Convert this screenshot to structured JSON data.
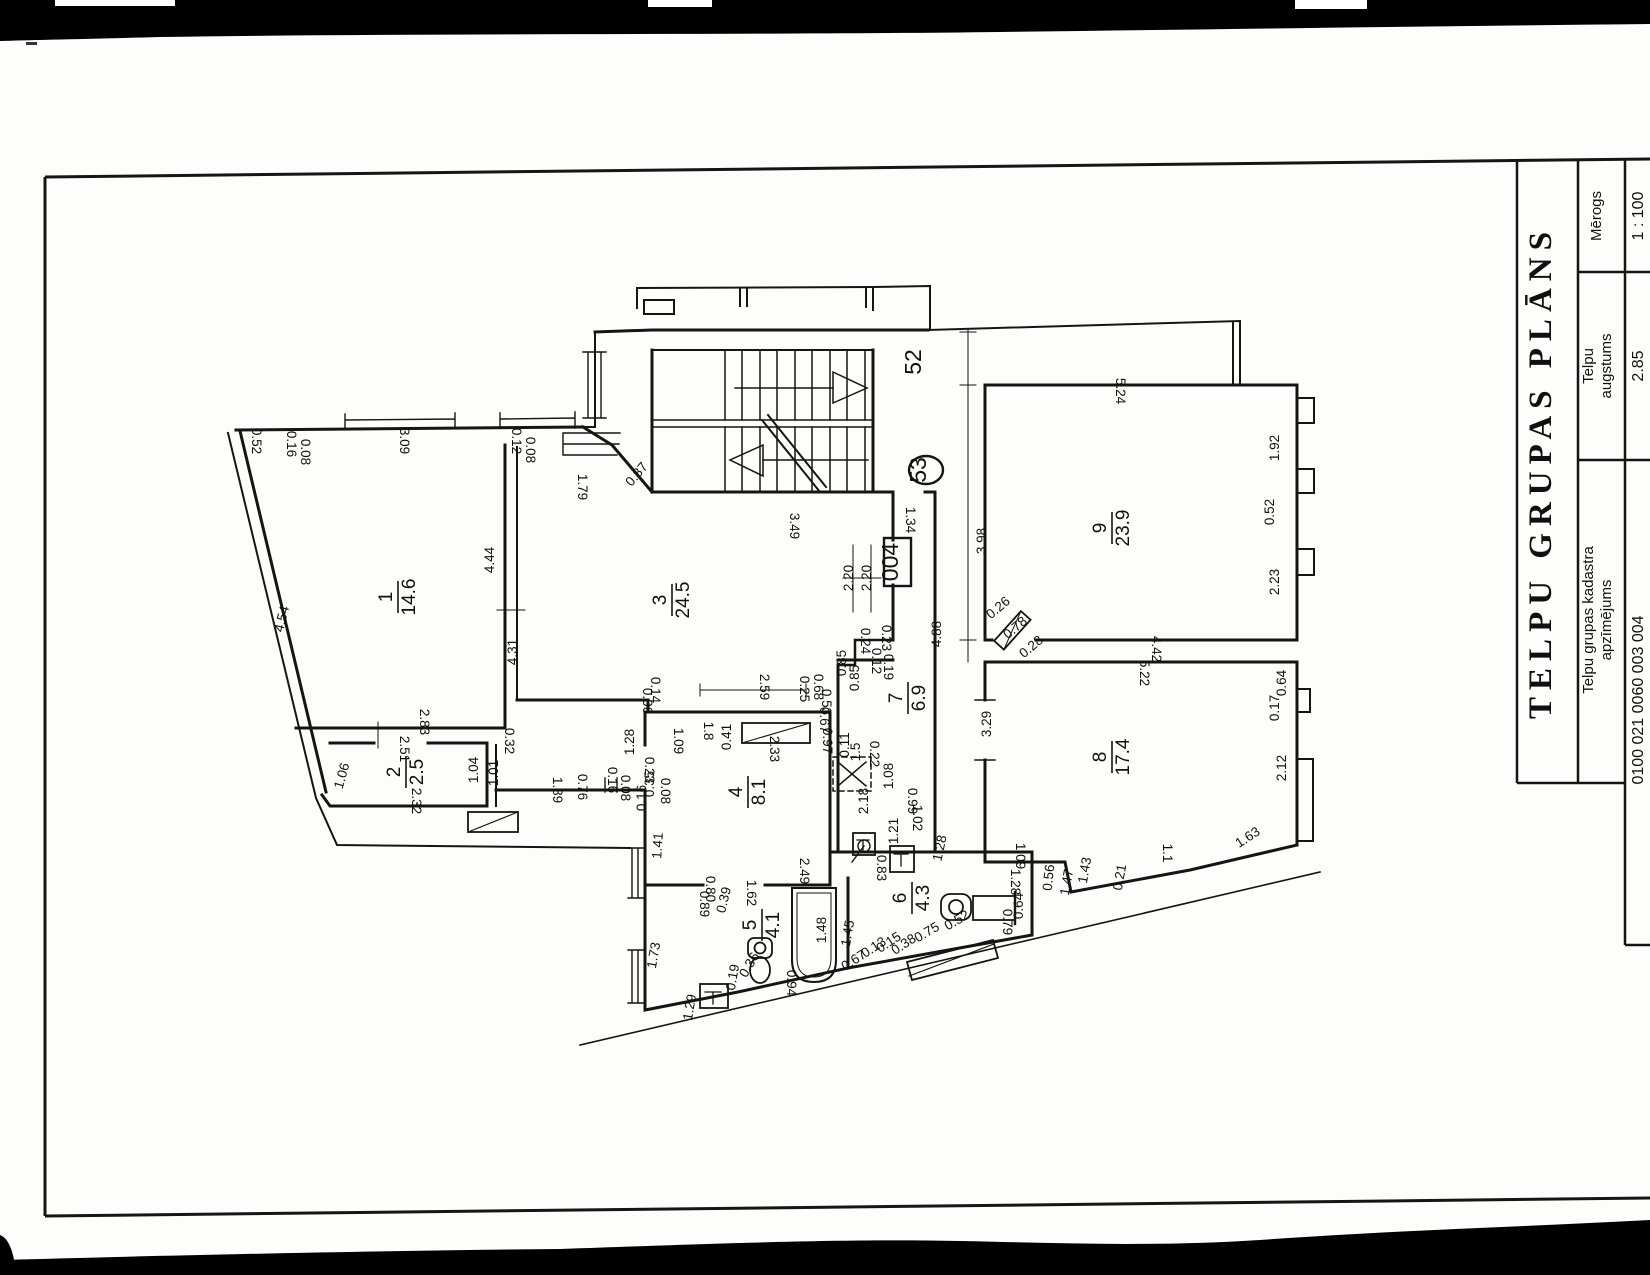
{
  "title_block": {
    "title": "TELPU GRUPAS PLĀNS",
    "fields": [
      {
        "label_lines": [
          "Mērogs"
        ],
        "value": "1 : 100"
      },
      {
        "label_lines": [
          "Telpu",
          "augstums"
        ],
        "value": "2.85"
      },
      {
        "label_lines": [
          "Telpu grupas kadastra",
          "apzīmējums"
        ],
        "value": "0100 021 0060 003 004"
      }
    ]
  },
  "plan": {
    "units": [
      {
        "label": "52",
        "x": 921,
        "y": 362
      },
      {
        "label": "53",
        "x": 926,
        "y": 470
      },
      {
        "label": "004",
        "x": 898,
        "y": 562
      }
    ],
    "rooms": [
      {
        "number": "1",
        "area": "14.6",
        "x": 398,
        "y": 597
      },
      {
        "number": "2",
        "area": "2.5",
        "x": 406,
        "y": 772
      },
      {
        "number": "3",
        "area": "24.5",
        "x": 672,
        "y": 600
      },
      {
        "number": "4",
        "area": "8.1",
        "x": 748,
        "y": 792
      },
      {
        "number": "5",
        "area": "4.1",
        "x": 762,
        "y": 925
      },
      {
        "number": "6",
        "area": "4.3",
        "x": 912,
        "y": 898
      },
      {
        "number": "7",
        "area": "6.9",
        "x": 908,
        "y": 698
      },
      {
        "number": "8",
        "area": "17.4",
        "x": 1112,
        "y": 757
      },
      {
        "number": "9",
        "area": "23.9",
        "x": 1112,
        "y": 528
      }
    ],
    "dimensions": [
      {
        "t": "0.52",
        "x": 252,
        "y": 441,
        "r": 90
      },
      {
        "t": "0.16",
        "x": 287,
        "y": 444,
        "r": 90
      },
      {
        "t": "0.08",
        "x": 301,
        "y": 452,
        "r": 90
      },
      {
        "t": "3.09",
        "x": 400,
        "y": 441,
        "r": 90
      },
      {
        "t": "0.12",
        "x": 512,
        "y": 441,
        "r": 90
      },
      {
        "t": "0.08",
        "x": 526,
        "y": 450,
        "r": 90
      },
      {
        "t": "4.54",
        "x": 286,
        "y": 620,
        "r": -76
      },
      {
        "t": "4.44",
        "x": 494,
        "y": 560,
        "r": -90
      },
      {
        "t": "4.31",
        "x": 517,
        "y": 652,
        "r": -90
      },
      {
        "t": "2.83",
        "x": 420,
        "y": 722,
        "r": 90
      },
      {
        "t": "2.51",
        "x": 400,
        "y": 749,
        "r": 90
      },
      {
        "t": "1.06",
        "x": 346,
        "y": 777,
        "r": -74
      },
      {
        "t": "1.04",
        "x": 478,
        "y": 770,
        "r": -90
      },
      {
        "t": "1.01",
        "x": 498,
        "y": 773,
        "r": -90
      },
      {
        "t": "0.32",
        "x": 505,
        "y": 741,
        "r": 90
      },
      {
        "t": "2.32",
        "x": 412,
        "y": 801,
        "r": 90
      },
      {
        "t": "1.89",
        "x": 553,
        "y": 790,
        "r": 90
      },
      {
        "t": "0.76",
        "x": 578,
        "y": 787,
        "r": 90
      },
      {
        "t": "0.16",
        "x": 608,
        "y": 780,
        "r": 90
      },
      {
        "t": "0.08",
        "x": 621,
        "y": 788,
        "r": 90
      },
      {
        "t": "1.79",
        "x": 578,
        "y": 487,
        "r": 90
      },
      {
        "t": "0.87",
        "x": 640,
        "y": 477,
        "r": -50
      },
      {
        "t": "3.49",
        "x": 790,
        "y": 526,
        "r": 90
      },
      {
        "t": "2.20",
        "x": 853,
        "y": 578,
        "r": -90
      },
      {
        "t": "2.20",
        "x": 871,
        "y": 578,
        "r": -90
      },
      {
        "t": "1.34",
        "x": 906,
        "y": 520,
        "r": 90
      },
      {
        "t": "3.98",
        "x": 986,
        "y": 541,
        "r": -90
      },
      {
        "t": "4.88",
        "x": 941,
        "y": 634,
        "r": -90
      },
      {
        "t": "0.24",
        "x": 861,
        "y": 641,
        "r": 90
      },
      {
        "t": "0.23",
        "x": 882,
        "y": 638,
        "r": 90
      },
      {
        "t": "0.85",
        "x": 846,
        "y": 663,
        "r": -90
      },
      {
        "t": "0.85",
        "x": 859,
        "y": 678,
        "r": -90
      },
      {
        "t": "0.12",
        "x": 872,
        "y": 661,
        "r": 90
      },
      {
        "t": "0.19",
        "x": 884,
        "y": 667,
        "r": 90
      },
      {
        "t": "0.25",
        "x": 800,
        "y": 689,
        "r": 90
      },
      {
        "t": "0.68",
        "x": 814,
        "y": 687,
        "r": 90
      },
      {
        "t": "0.53",
        "x": 822,
        "y": 702,
        "r": 90
      },
      {
        "t": "0.67",
        "x": 820,
        "y": 720,
        "r": 90
      },
      {
        "t": "0.97",
        "x": 823,
        "y": 741,
        "r": 90
      },
      {
        "t": "2.59",
        "x": 760,
        "y": 687,
        "r": 90
      },
      {
        "t": "0.41",
        "x": 731,
        "y": 737,
        "r": -90
      },
      {
        "t": "2.33",
        "x": 770,
        "y": 749,
        "r": 90
      },
      {
        "t": "1.8",
        "x": 704,
        "y": 731,
        "r": 90
      },
      {
        "t": "1.09",
        "x": 674,
        "y": 741,
        "r": 90
      },
      {
        "t": "1.28",
        "x": 634,
        "y": 742,
        "r": -90
      },
      {
        "t": "0.14",
        "x": 651,
        "y": 690,
        "r": 90
      },
      {
        "t": "0.06",
        "x": 643,
        "y": 701,
        "r": 90
      },
      {
        "t": "0.23",
        "x": 645,
        "y": 770,
        "r": 90
      },
      {
        "t": "0.35",
        "x": 654,
        "y": 784,
        "r": -90
      },
      {
        "t": "0.16",
        "x": 646,
        "y": 798,
        "r": -90
      },
      {
        "t": "0.08",
        "x": 661,
        "y": 791,
        "r": 90
      },
      {
        "t": "0.11",
        "x": 849,
        "y": 745,
        "r": -90
      },
      {
        "t": "1.5",
        "x": 860,
        "y": 752,
        "r": -90
      },
      {
        "t": "0.22",
        "x": 870,
        "y": 754,
        "r": 90
      },
      {
        "t": "1.08",
        "x": 893,
        "y": 776,
        "r": -90
      },
      {
        "t": "0.99",
        "x": 908,
        "y": 801,
        "r": 90
      },
      {
        "t": "1.02",
        "x": 913,
        "y": 818,
        "r": 90
      },
      {
        "t": "1.21",
        "x": 898,
        "y": 831,
        "r": -90
      },
      {
        "t": "1.28",
        "x": 944,
        "y": 849,
        "r": -78
      },
      {
        "t": "2.18",
        "x": 868,
        "y": 801,
        "r": -90
      },
      {
        "t": "1.41",
        "x": 662,
        "y": 846,
        "r": -86
      },
      {
        "t": "2.49",
        "x": 800,
        "y": 871,
        "r": 90
      },
      {
        "t": "0.80",
        "x": 706,
        "y": 889,
        "r": 90
      },
      {
        "t": "0.89",
        "x": 700,
        "y": 904,
        "r": 90
      },
      {
        "t": "0.39",
        "x": 728,
        "y": 901,
        "r": -76
      },
      {
        "t": "1.62",
        "x": 747,
        "y": 893,
        "r": 90
      },
      {
        "t": "1.48",
        "x": 826,
        "y": 930,
        "r": -90
      },
      {
        "t": "1.73",
        "x": 658,
        "y": 956,
        "r": -80
      },
      {
        "t": "1.29",
        "x": 694,
        "y": 1008,
        "r": -80
      },
      {
        "t": "0.19",
        "x": 737,
        "y": 978,
        "r": -80
      },
      {
        "t": "0.36",
        "x": 753,
        "y": 967,
        "r": -60
      },
      {
        "t": "0.94",
        "x": 787,
        "y": 983,
        "r": 90
      },
      {
        "t": "1.45",
        "x": 852,
        "y": 934,
        "r": -80
      },
      {
        "t": "0.83",
        "x": 877,
        "y": 868,
        "r": 90
      },
      {
        "t": "0.67",
        "x": 856,
        "y": 964,
        "r": -33
      },
      {
        "t": "0.13",
        "x": 876,
        "y": 951,
        "r": -33
      },
      {
        "t": "0.15",
        "x": 891,
        "y": 946,
        "r": -33
      },
      {
        "t": "0.38",
        "x": 906,
        "y": 948,
        "r": -33
      },
      {
        "t": "0.75",
        "x": 929,
        "y": 936,
        "r": -30
      },
      {
        "t": "0.52",
        "x": 959,
        "y": 924,
        "r": -30
      },
      {
        "t": "0.79",
        "x": 1003,
        "y": 922,
        "r": 90
      },
      {
        "t": "0.64",
        "x": 1023,
        "y": 906,
        "r": -90
      },
      {
        "t": "1.28",
        "x": 1011,
        "y": 882,
        "r": 90
      },
      {
        "t": "0.56",
        "x": 1053,
        "y": 878,
        "r": -84
      },
      {
        "t": "1.47",
        "x": 1071,
        "y": 883,
        "r": -80
      },
      {
        "t": "1.43",
        "x": 1089,
        "y": 871,
        "r": -80
      },
      {
        "t": "0.21",
        "x": 1124,
        "y": 878,
        "r": -80
      },
      {
        "t": "1.09",
        "x": 1016,
        "y": 856,
        "r": 90
      },
      {
        "t": "1.1",
        "x": 1163,
        "y": 853,
        "r": 90
      },
      {
        "t": "1.63",
        "x": 1250,
        "y": 841,
        "r": -33
      },
      {
        "t": "5.22",
        "x": 1140,
        "y": 673,
        "r": 90
      },
      {
        "t": "4.42",
        "x": 1152,
        "y": 649,
        "r": 90
      },
      {
        "t": "3.29",
        "x": 991,
        "y": 724,
        "r": -90
      },
      {
        "t": "0.64",
        "x": 1286,
        "y": 683,
        "r": -90
      },
      {
        "t": "0.17",
        "x": 1279,
        "y": 708,
        "r": -90
      },
      {
        "t": "2.12",
        "x": 1286,
        "y": 768,
        "r": -90
      },
      {
        "t": "5.24",
        "x": 1116,
        "y": 391,
        "r": 90
      },
      {
        "t": "1.92",
        "x": 1279,
        "y": 448,
        "r": -90
      },
      {
        "t": "0.52",
        "x": 1274,
        "y": 512,
        "r": -90
      },
      {
        "t": "2.23",
        "x": 1279,
        "y": 582,
        "r": -90
      },
      {
        "t": "0.26",
        "x": 1001,
        "y": 611,
        "r": -40
      },
      {
        "t": "0.78",
        "x": 1018,
        "y": 631,
        "r": -40
      },
      {
        "t": "0.28",
        "x": 1034,
        "y": 650,
        "r": -40
      }
    ]
  }
}
